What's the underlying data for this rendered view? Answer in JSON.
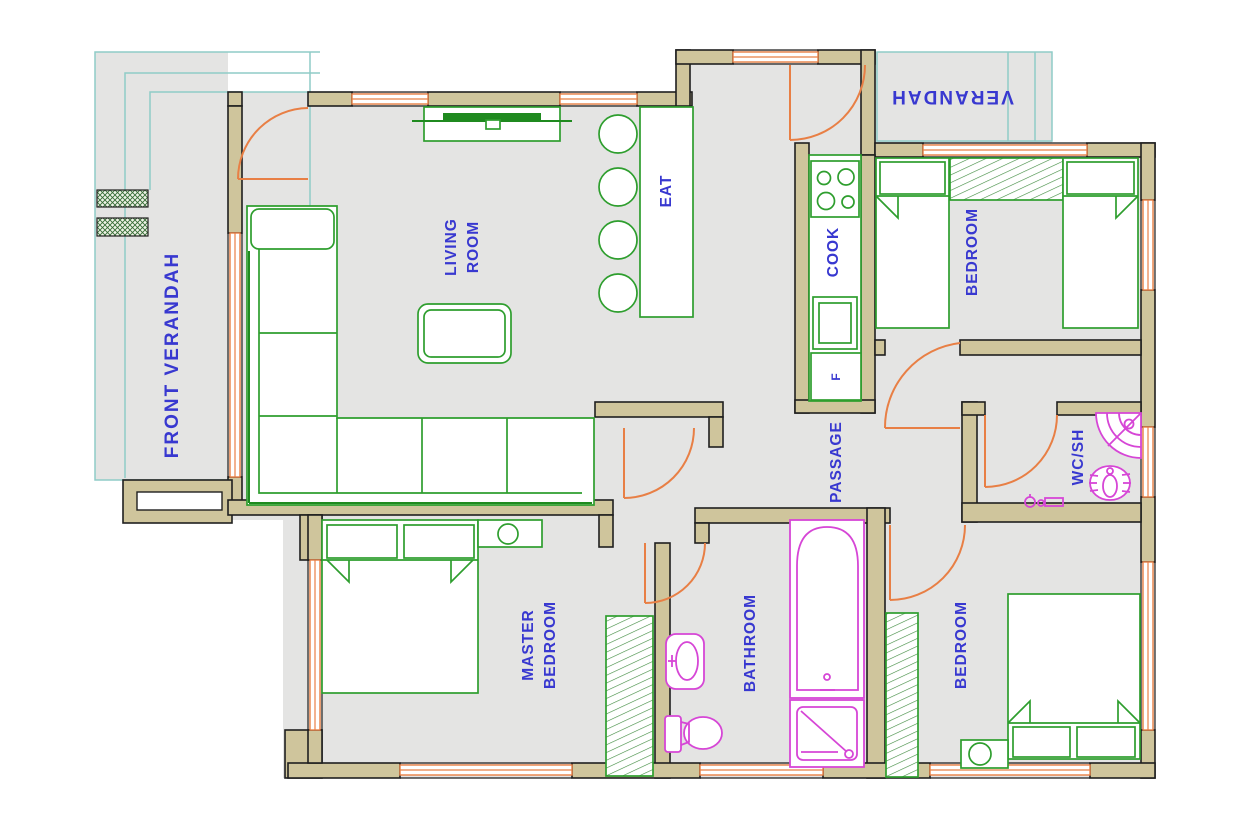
{
  "title": "house-floor-plan",
  "labels": {
    "front_verandah": "FRONT VERANDAH",
    "living_room": [
      "LIVING",
      "ROOM"
    ],
    "eat": "EAT",
    "cook": "COOK",
    "verandah_rear": "VERANDAH",
    "bedroom_top": "BEDROOM",
    "passage": "PASSAGE",
    "wc_shower": "WC/SH",
    "master_bedroom": [
      "MASTER",
      "BEDROOM"
    ],
    "bathroom": "BATHROOM",
    "bedroom_bottom": "BEDROOM",
    "refrigerator": "F"
  },
  "colors": {
    "background": "#ffffff",
    "floor": "#e4e4e3",
    "wall_fill": "#cfc59c",
    "wall_outline": "#1f1f1f",
    "door_window": "#e87f45",
    "furniture": "#2e9e2e",
    "sanitary_fixture": "#d646d6",
    "room_label": "#3838d0",
    "verandah_outline": "#8fccc7"
  },
  "furniture": [
    {
      "id": "l-shaped-sofa",
      "room": "living room"
    },
    {
      "id": "coffee-table",
      "room": "living room"
    },
    {
      "id": "tv-unit",
      "room": "living room"
    },
    {
      "id": "breakfast-counter",
      "room": "eat"
    },
    {
      "id": "bar-stools",
      "count": 4,
      "room": "eat"
    },
    {
      "id": "stove-4-burner",
      "room": "cook"
    },
    {
      "id": "kitchen-sink",
      "room": "cook"
    },
    {
      "id": "refrigerator",
      "label": "F",
      "room": "cook"
    },
    {
      "id": "twin-bed",
      "count": 2,
      "room": "bedroom top"
    },
    {
      "id": "wardrobe",
      "count": 3,
      "rooms": "bedroom top / master bedroom / bedroom bottom"
    },
    {
      "id": "double-bed",
      "count": 2,
      "rooms": "master bedroom / bedroom bottom"
    },
    {
      "id": "dressing-table",
      "room": "master bedroom"
    },
    {
      "id": "bedside-table",
      "room": "bedroom bottom"
    },
    {
      "id": "wash-basin",
      "room": "bathroom"
    },
    {
      "id": "toilet",
      "room": "bathroom"
    },
    {
      "id": "bathtub",
      "room": "bathroom"
    },
    {
      "id": "shower-tray",
      "room": "bathroom"
    },
    {
      "id": "corner-shower-basin",
      "room": "wc/sh"
    },
    {
      "id": "squat-toilet",
      "room": "wc/sh"
    },
    {
      "id": "entry-steps",
      "room": "front verandah"
    }
  ]
}
